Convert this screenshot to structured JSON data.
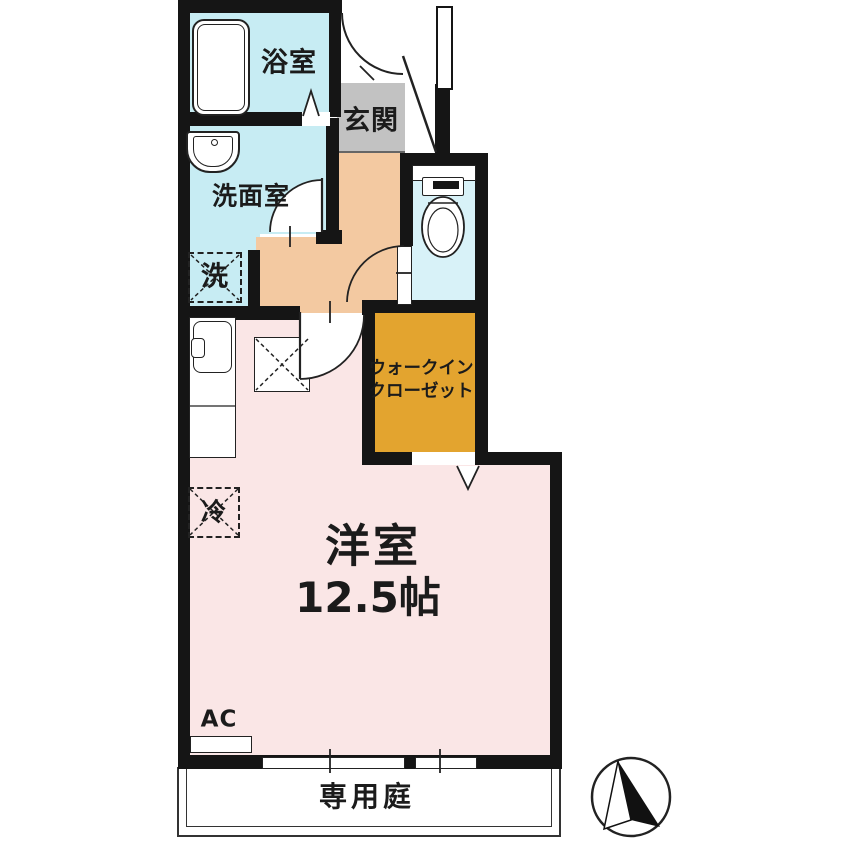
{
  "floorplan": {
    "rooms": {
      "bathroom": {
        "label": "浴室"
      },
      "entrance": {
        "label": "玄関"
      },
      "washroom": {
        "label": "洗面室"
      },
      "washing_machine": {
        "label": "洗"
      },
      "walk_in_closet": {
        "label_line1": "ウォークイン",
        "label_line2": "クローゼット"
      },
      "western_room": {
        "label": "洋室",
        "size": "12.5帖"
      },
      "refrigerator": {
        "label": "冷"
      },
      "air_conditioner": {
        "label": "AC"
      },
      "private_garden": {
        "label": "専用庭"
      }
    },
    "colors": {
      "wall": "#151515",
      "bathroom_fill": "#c7ecf3",
      "washroom_fill": "#c7ecf3",
      "toilet_fill": "#d8f2f8",
      "entrance_fill": "#c2c2c2",
      "hallway_fill": "#f3c9a1",
      "closet_fill": "#e3a42f",
      "room_fill": "#fae6e6",
      "background": "#ffffff"
    }
  }
}
